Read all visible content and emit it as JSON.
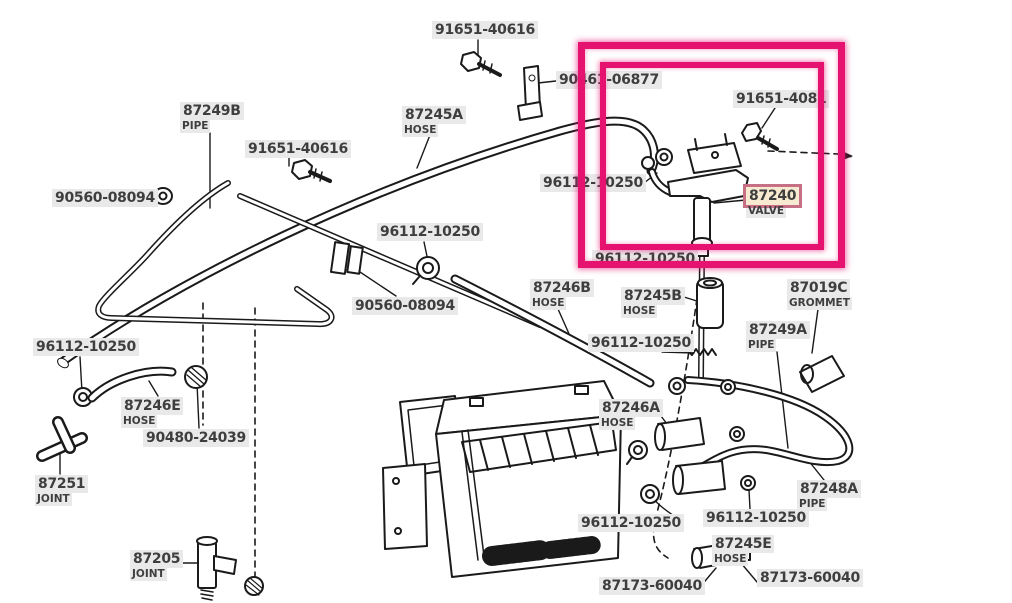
{
  "diagram": {
    "description": "Heater hose and pipe exploded parts diagram with highlighted water valve",
    "colors": {
      "background": "#ffffff",
      "line_ink": "#1a1a1a",
      "label_background": "#e9e9e9",
      "label_text": "#3e3e3e",
      "highlight_box": "#e51270",
      "highlighted_label_background": "#f7ead1",
      "highlighted_label_border": "#c76f85"
    },
    "highlight_box": {
      "outer": {
        "x": 578,
        "y": 42,
        "width": 267,
        "height": 226
      },
      "inner": {
        "x": 600,
        "y": 62,
        "width": 224,
        "height": 188
      }
    },
    "labels": [
      {
        "part": "91651-40616",
        "x": 432,
        "y": 21
      },
      {
        "part": "90461-06877",
        "x": 556,
        "y": 71
      },
      {
        "part": "91651-4081",
        "x": 733,
        "y": 90
      },
      {
        "part": "87249B",
        "sub": "PIPE",
        "x": 180,
        "y": 102
      },
      {
        "part": "87245A",
        "sub": "HOSE",
        "x": 402,
        "y": 106
      },
      {
        "part": "91651-40616",
        "x": 245,
        "y": 140
      },
      {
        "part": "90560-08094",
        "x": 52,
        "y": 189
      },
      {
        "part": "96112-10250",
        "x": 540,
        "y": 174
      },
      {
        "part": "87240",
        "sub": "VALVE",
        "x": 746,
        "y": 187,
        "highlighted": true
      },
      {
        "part": "96112-10250",
        "x": 377,
        "y": 223
      },
      {
        "part": "96112-10250",
        "x": 592,
        "y": 250,
        "obscured": true
      },
      {
        "part": "90560-08094",
        "x": 352,
        "y": 297
      },
      {
        "part": "87246B",
        "sub": "HOSE",
        "x": 530,
        "y": 279
      },
      {
        "part": "87245B",
        "sub": "HOSE",
        "x": 621,
        "y": 287
      },
      {
        "part": "87019C",
        "sub": "GROMMET",
        "x": 787,
        "y": 279
      },
      {
        "part": "96112-10250",
        "x": 588,
        "y": 334
      },
      {
        "part": "87249A",
        "sub": "PIPE",
        "x": 746,
        "y": 321
      },
      {
        "part": "96112-10250",
        "x": 33,
        "y": 338
      },
      {
        "part": "87246E",
        "sub": "HOSE",
        "x": 121,
        "y": 397
      },
      {
        "part": "90480-24039",
        "x": 143,
        "y": 429
      },
      {
        "part": "87246A",
        "sub": "HOSE",
        "x": 599,
        "y": 399
      },
      {
        "part": "87251",
        "sub": "JOINT",
        "x": 35,
        "y": 475
      },
      {
        "part": "87248A",
        "sub": "PIPE",
        "x": 797,
        "y": 480
      },
      {
        "part": "96112-10250",
        "x": 578,
        "y": 514
      },
      {
        "part": "96112-10250",
        "x": 703,
        "y": 509
      },
      {
        "part": "87245E",
        "sub": "HOSE",
        "x": 712,
        "y": 535
      },
      {
        "part": "87205",
        "sub": "JOINT",
        "x": 130,
        "y": 550
      },
      {
        "part": "87173-60040",
        "x": 599,
        "y": 577
      },
      {
        "part": "87173-60040",
        "x": 757,
        "y": 569
      }
    ]
  }
}
